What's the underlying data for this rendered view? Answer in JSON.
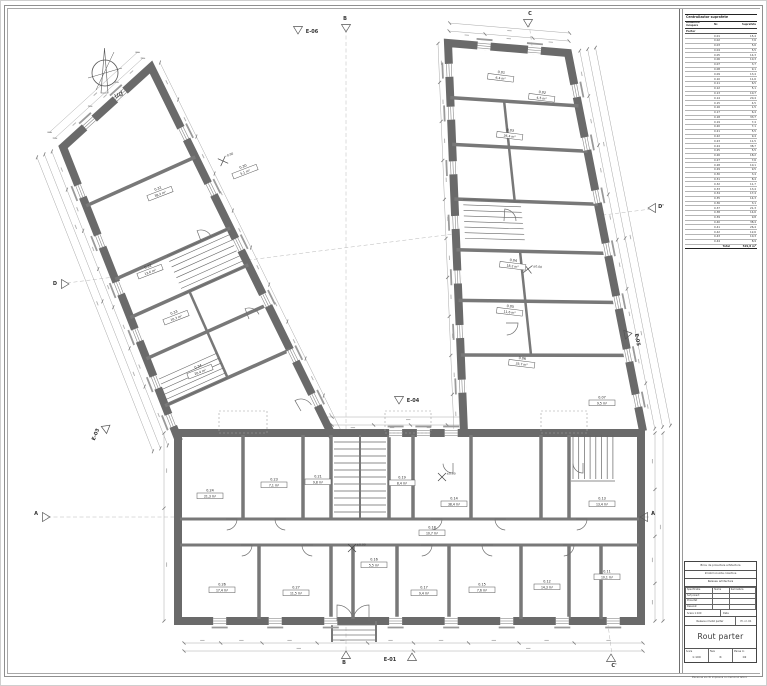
{
  "north": {
    "label": "ud"
  },
  "plan": {
    "markers": [
      [
        "E-06",
        311,
        32,
        0,
        297,
        29,
        180
      ],
      [
        "B",
        344,
        19,
        0,
        345,
        27,
        180
      ],
      [
        "C",
        529,
        14,
        0,
        527,
        22,
        180
      ],
      [
        "D",
        54,
        284,
        0,
        64,
        283,
        90
      ],
      [
        "D'",
        660,
        207,
        0,
        651,
        207,
        -90
      ],
      [
        "A",
        35,
        514,
        0,
        45,
        516,
        90
      ],
      [
        "A",
        652,
        514,
        0,
        643,
        516,
        -90
      ],
      [
        "B",
        343,
        663,
        0,
        345,
        654,
        0
      ],
      [
        "E-01",
        389,
        660,
        0,
        411,
        656,
        0
      ],
      [
        "C'",
        613,
        666,
        0,
        610,
        657,
        0
      ],
      [
        "E-04",
        412,
        401,
        0,
        398,
        399,
        180
      ],
      [
        "E-03",
        96,
        434,
        -68,
        104,
        427,
        -68
      ],
      [
        "E-05",
        635,
        339,
        79,
        627,
        333,
        79
      ]
    ],
    "rooms": [
      [
        "0.31",
        "38,2 m²",
        158,
        190,
        -21
      ],
      [
        "0.30",
        "5,1 m²",
        243,
        168,
        -21
      ],
      [
        "0.32",
        "12,6 m²",
        148,
        268,
        -21
      ],
      [
        "0.33",
        "10,3 m²",
        174,
        314,
        -21
      ],
      [
        "0.34",
        "20,4 m²",
        198,
        368,
        -21
      ],
      [
        "0.01",
        "6,4 m²",
        500,
        74,
        7
      ],
      [
        "0.02",
        "4,5 m²",
        541,
        94,
        7
      ],
      [
        "0.03",
        "26,4 m²",
        509,
        132,
        7
      ],
      [
        "0.04",
        "18,2 m²",
        512,
        262,
        7
      ],
      [
        "0.05",
        "11,6 m²",
        509,
        308,
        7
      ],
      [
        "0.06",
        "33,7 m²",
        521,
        360,
        7
      ],
      [
        "0.07",
        "9,5 m²",
        601,
        399,
        0
      ],
      [
        "0.24",
        "21,3 m²",
        209,
        492,
        0
      ],
      [
        "0.23",
        "7,1 m²",
        273,
        481,
        0
      ],
      [
        "0.21",
        "9,8 m²",
        317,
        478,
        0
      ],
      [
        "0.19",
        "8,4 m²",
        401,
        479,
        0
      ],
      [
        "0.14",
        "38,4 m²",
        453,
        500,
        0
      ],
      [
        "0.13",
        "13,4 m²",
        601,
        500,
        0
      ],
      [
        "0.18",
        "10,7 m²",
        431,
        529,
        0
      ],
      [
        "0.26",
        "17,4 m²",
        221,
        586,
        0
      ],
      [
        "0.27",
        "11,5 m²",
        295,
        589,
        0
      ],
      [
        "0.16",
        "5,5 m²",
        373,
        561,
        0
      ],
      [
        "0.17",
        "9,4 m²",
        423,
        589,
        0
      ],
      [
        "0.15",
        "7,6 m²",
        481,
        586,
        0
      ],
      [
        "0.12",
        "14,3 m²",
        546,
        583,
        0
      ],
      [
        "0.11",
        "10,1 m²",
        606,
        573,
        0
      ]
    ],
    "levels": [
      [
        "±0.00",
        441,
        476,
        0
      ],
      [
        "±0.00",
        351,
        547,
        0
      ],
      [
        "-0.90",
        222,
        160,
        -21
      ],
      [
        "±0.00",
        527,
        268,
        7
      ]
    ]
  },
  "schedule": {
    "title": "Centralizator suprafete",
    "headers": [
      "Denumire incapere",
      "Nr.",
      "Suprafata"
    ],
    "group": "Parter",
    "rows": [
      [
        "0.01",
        "15,4"
      ],
      [
        "0.02",
        "7,6"
      ],
      [
        "0.03",
        "5,6"
      ],
      [
        "0.04",
        "5,5"
      ],
      [
        "0.05",
        "14,3"
      ],
      [
        "0.06",
        "10,3"
      ],
      [
        "0.07",
        "3,7"
      ],
      [
        "0.08",
        "9,1"
      ],
      [
        "0.09",
        "13,4"
      ],
      [
        "0.10",
        "11,6"
      ],
      [
        "0.11",
        "6,5"
      ],
      [
        "0.12",
        "5,1"
      ],
      [
        "0.13",
        "10,7"
      ],
      [
        "0.14",
        "20,4"
      ],
      [
        "0.15",
        "4,5"
      ],
      [
        "0.16",
        "1,5"
      ],
      [
        "0.17",
        "6,4"
      ],
      [
        "0.18",
        "33,7"
      ],
      [
        "0.19",
        "7,4"
      ],
      [
        "0.20",
        "7,1"
      ],
      [
        "0.21",
        "5,5"
      ],
      [
        "0.22",
        "9,4"
      ],
      [
        "0.23",
        "11,5"
      ],
      [
        "0.24",
        "38,7"
      ],
      [
        "0.25",
        "5,5"
      ],
      [
        "0.26",
        "18,2"
      ],
      [
        "0.27",
        "7,6"
      ],
      [
        "0.28",
        "10,1"
      ],
      [
        "0.29",
        "9,5"
      ],
      [
        "0.30",
        "3,4"
      ],
      [
        "0.31",
        "8,4"
      ],
      [
        "0.32",
        "11,7"
      ],
      [
        "0.33",
        "13,4"
      ],
      [
        "0.34",
        "17,4"
      ],
      [
        "0.35",
        "14,3"
      ],
      [
        "0.36",
        "3,1"
      ],
      [
        "0.37",
        "21,3"
      ],
      [
        "0.38",
        "14,6"
      ],
      [
        "0.39",
        "9,8"
      ],
      [
        "0.40",
        "38,4"
      ],
      [
        "0.41",
        "26,4"
      ],
      [
        "0.42",
        "12,6"
      ],
      [
        "0.43",
        "10,3"
      ],
      [
        "0.44",
        "8,9"
      ]
    ],
    "total_label": "Total",
    "total": "529,8 m²"
  },
  "titleblock": {
    "bars": [
      "Birou de proiectare arhitectura",
      "Imobil locuinte colective",
      "Releveu arhitectura"
    ],
    "spec_headers": [
      "Specificatie",
      "Nume",
      "Semnatura"
    ],
    "spec_rows": [
      "Sef proiect",
      "Proiectat",
      "Desenat"
    ],
    "scale_label": "Scara",
    "scale": "1:100",
    "date_label": "Data",
    "project": "Releveu imobil parter",
    "project_no": "Pr. nr. 01",
    "title": "Rout parter",
    "bottom": [
      {
        "label": "Scara",
        "value": "1:100"
      },
      {
        "label": "Faza",
        "value": "R"
      },
      {
        "label": "Plansa nr.",
        "value": "02"
      }
    ],
    "footer": "Plansa se va citi impreuna cu memoriul tehnic"
  }
}
